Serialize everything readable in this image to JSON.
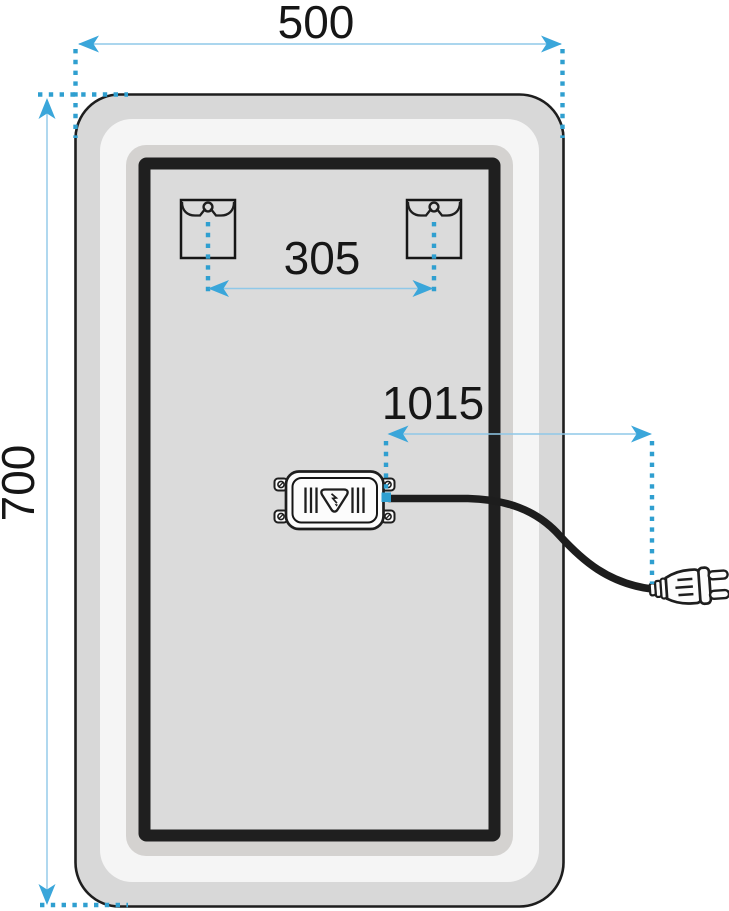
{
  "dims": {
    "width": "500",
    "height": "700",
    "bracket_spacing": "305",
    "cable_length": "1015"
  },
  "colors": {
    "accent_arrow": "#3aa6da",
    "dimension_line": "#8fc8e8",
    "dotted_line": "#2f9fd0",
    "outline_ink": "#1e1e1e",
    "mirror_frame_gray": "#d8d8d8",
    "led_band_white": "#f5f5f5",
    "mid_band_gray": "#d4d2d0",
    "inner_gray": "#dbdbdb"
  },
  "icons": {
    "mounting_bracket_icon": "keyhole-slot",
    "driver_warning_icon": "triangle-lightning-bolt",
    "power_plug_icon": "euro-plug-two-prong",
    "power_cable_icon": "curved-black-cable"
  }
}
